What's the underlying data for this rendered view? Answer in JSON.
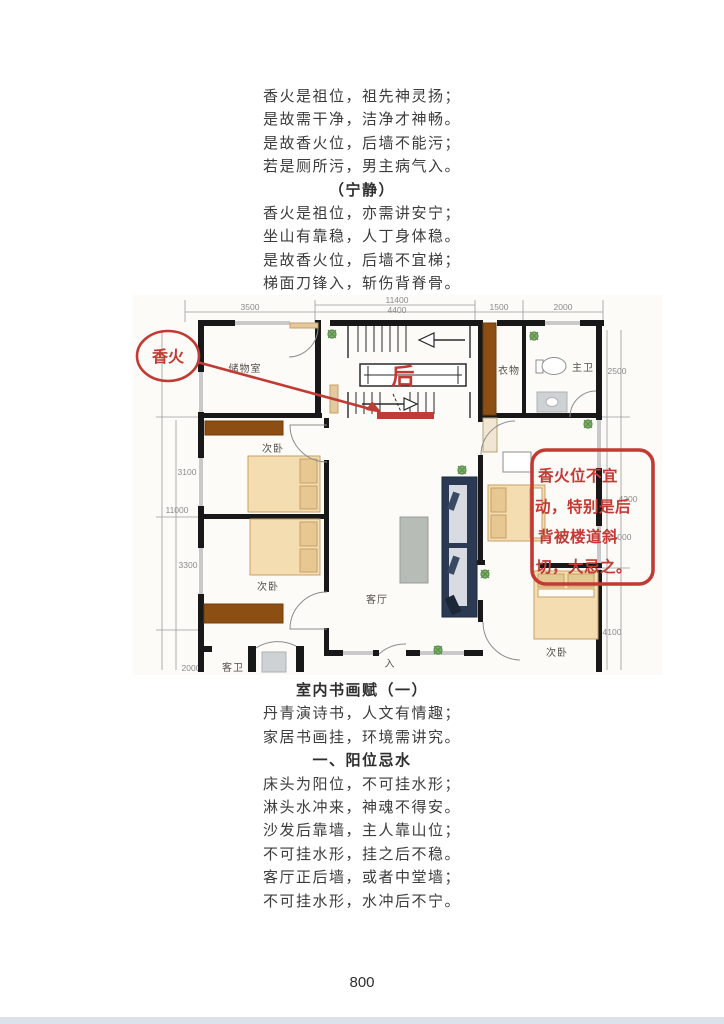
{
  "section1": {
    "lines": [
      "香火是祖位，祖先神灵扬；",
      "是故需干净，洁净才神畅。",
      "是故香火位，后墙不能污；",
      "若是厕所污，男主病气入。"
    ],
    "heading": "（宁静）",
    "lines2": [
      "香火是祖位，亦需讲安宁；",
      "坐山有靠稳，人丁身体稳。",
      "是故香火位，后墙不宜梯；",
      "梯面刀锋入，斩伤背脊骨。"
    ]
  },
  "section2": {
    "title": "室内书画赋（一）",
    "lines": [
      "丹青演诗书，人文有情趣；",
      "家居书画挂，环境需讲究。"
    ],
    "subheading": "一、阳位忌水",
    "lines2": [
      "床头为阳位，不可挂水形；",
      "淋头水冲来，神魂不得安。",
      "沙发后靠墙，主人靠山位；",
      "不可挂水形，挂之后不稳。",
      "客厅正后墙，或者中堂墙；",
      "不可挂水形，水冲后不宁。"
    ]
  },
  "floorplan": {
    "rooms": {
      "storage": "储物室",
      "bedroom1": "次卧",
      "bedroom2": "次卧",
      "bedroom3": "次卧",
      "living": "客厅",
      "closet": "衣物",
      "master_bath": "主卫",
      "guest_bath": "客卫",
      "entry": "入"
    },
    "dims": {
      "top_total": "11400",
      "top": [
        "3500",
        "4400",
        "1500",
        "2000"
      ],
      "left": [
        "3100",
        "11000",
        "3300",
        "2000"
      ],
      "right": [
        "2500",
        "4200",
        "11000",
        "4100"
      ]
    },
    "annotations": {
      "ellipse_label": "香火",
      "rear_label": "后",
      "note_lines": [
        "香火位不宜",
        "动，特别是后",
        "背被楼道斜",
        "切，大忌之。"
      ],
      "accent_red": "#c23a34"
    }
  },
  "page_number": "800"
}
